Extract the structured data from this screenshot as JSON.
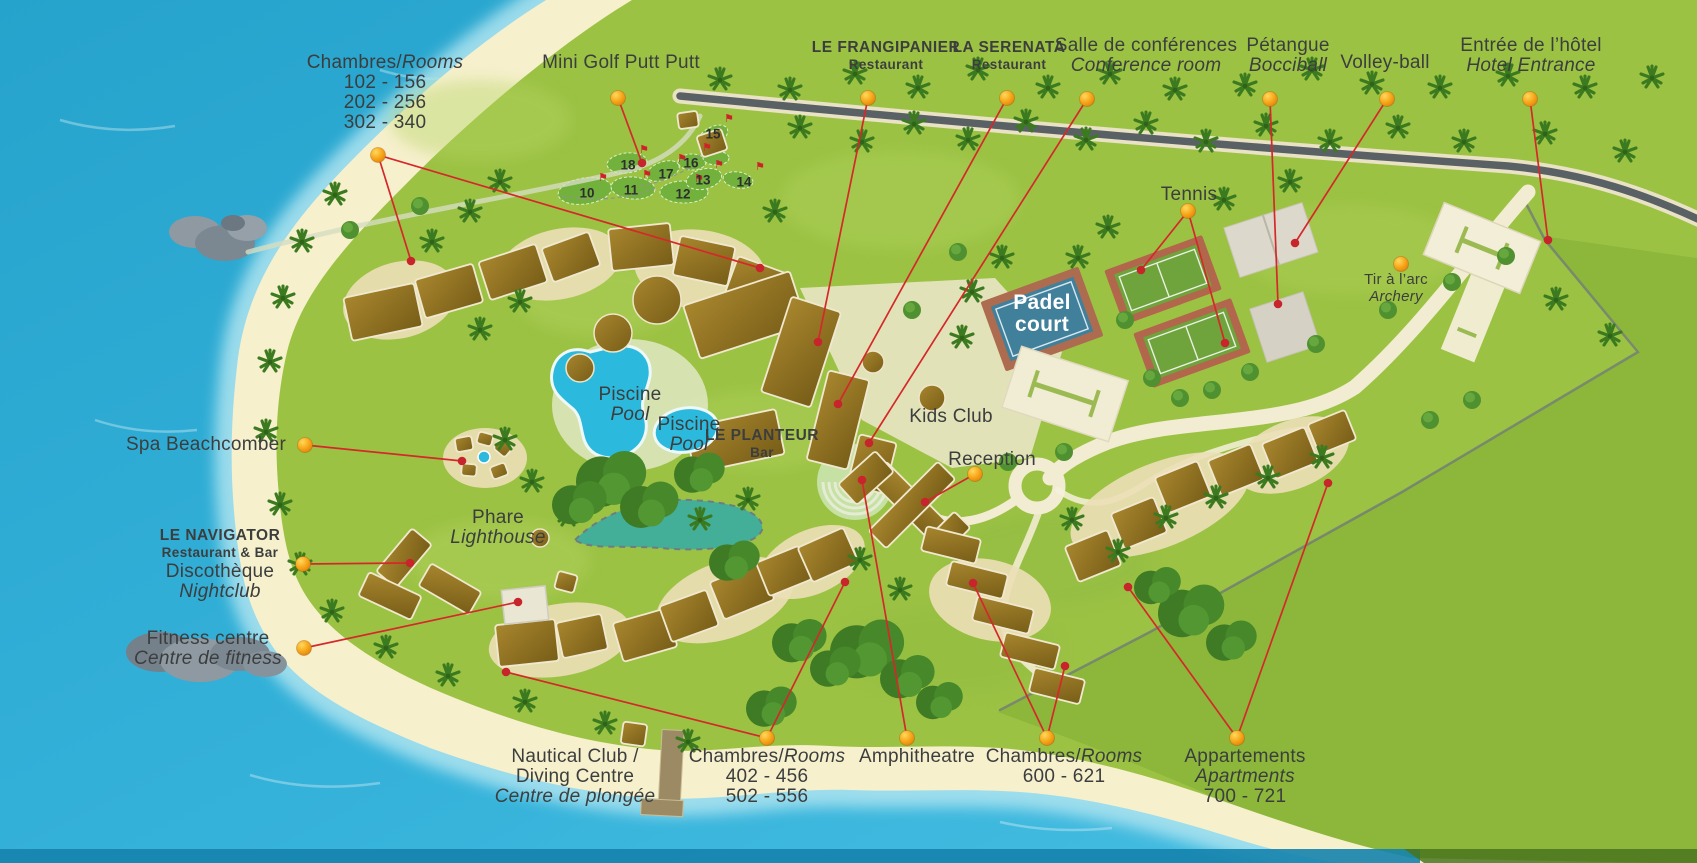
{
  "map_title": "Resort grounds map",
  "colors": {
    "water": "#2aa9d2",
    "water_light": "#49bfe2",
    "sand": "#f6f0cd",
    "grass": "#9cc244",
    "grass_outside": "#7fae33",
    "roof": "#8a6c1e",
    "callout_line": "#d5282a",
    "callout_dot": "#f7a61b",
    "label_text": "#3c3e3e",
    "pool": "#2cb9de",
    "padel_blue": "#41809b",
    "tennis_green": "#6fa33c",
    "court_clay": "#b2664b",
    "road_dark": "#596165",
    "path_cream": "#f2ecd2"
  },
  "callouts": [
    {
      "id": "rooms-nw",
      "x": 385,
      "y": 53,
      "lines": [
        [
          [
            "Chambres/",
            "r"
          ],
          [
            "Rooms",
            "i"
          ]
        ],
        [
          [
            "102 - 156",
            "r"
          ]
        ],
        [
          [
            "202 - 256",
            "r"
          ]
        ],
        [
          [
            "302 - 340",
            "r"
          ]
        ]
      ],
      "dot": [
        378,
        155
      ],
      "targets": [
        [
          411,
          261
        ],
        [
          760,
          268
        ]
      ]
    },
    {
      "id": "mini-golf",
      "x": 621,
      "y": 53,
      "lines": [
        [
          [
            "Mini Golf Putt Putt",
            "r"
          ]
        ]
      ],
      "dot": [
        618,
        98
      ],
      "targets": [
        [
          642,
          163
        ]
      ]
    },
    {
      "id": "frangipanier",
      "x": 886,
      "y": 40,
      "lines": [
        [
          [
            "LE FRANGIPANIER",
            "b"
          ]
        ],
        [
          [
            "Restaurant",
            "b2"
          ]
        ]
      ],
      "dot": [
        868,
        98
      ],
      "targets": [
        [
          818,
          342
        ]
      ]
    },
    {
      "id": "serenata",
      "x": 1009,
      "y": 40,
      "lines": [
        [
          [
            "LA SERENATA",
            "b"
          ]
        ],
        [
          [
            "Restaurant",
            "b2"
          ]
        ]
      ],
      "dot": [
        1007,
        98
      ],
      "targets": [
        [
          838,
          404
        ]
      ]
    },
    {
      "id": "conference",
      "x": 1146,
      "y": 36,
      "lines": [
        [
          [
            "Salle de conférences",
            "r"
          ]
        ],
        [
          [
            "Conference room",
            "i"
          ]
        ]
      ],
      "dot": [
        1087,
        99
      ],
      "targets": [
        [
          869,
          443
        ]
      ]
    },
    {
      "id": "petangue",
      "x": 1288,
      "y": 36,
      "lines": [
        [
          [
            "Pétangue",
            "r"
          ]
        ],
        [
          [
            "Bocciball",
            "i"
          ]
        ]
      ],
      "dot": [
        1270,
        99
      ],
      "targets": [
        [
          1278,
          304
        ]
      ]
    },
    {
      "id": "volleyball",
      "x": 1385,
      "y": 53,
      "lines": [
        [
          [
            "Volley-ball",
            "r"
          ]
        ]
      ],
      "dot": [
        1387,
        99
      ],
      "targets": [
        [
          1295,
          243
        ]
      ]
    },
    {
      "id": "hotel-entrance",
      "x": 1531,
      "y": 36,
      "lines": [
        [
          [
            "Entrée de l’hôtel",
            "r"
          ]
        ],
        [
          [
            "Hotel Entrance",
            "i"
          ]
        ]
      ],
      "dot": [
        1530,
        99
      ],
      "targets": [
        [
          1548,
          240
        ]
      ]
    },
    {
      "id": "tennis",
      "x": 1189,
      "y": 185,
      "lines": [
        [
          [
            "Tennis",
            "r"
          ]
        ]
      ],
      "dot": [
        1188,
        211
      ],
      "targets": [
        [
          1141,
          270
        ],
        [
          1225,
          343
        ]
      ]
    },
    {
      "id": "padel-court",
      "x": 1042,
      "y": 292,
      "lines": [
        [
          [
            "Padel",
            "w"
          ]
        ],
        [
          [
            "court",
            "w"
          ]
        ]
      ]
    },
    {
      "id": "archery",
      "x": 1396,
      "y": 272,
      "lines": [
        [
          [
            "Tir à l’arc",
            "sm"
          ]
        ],
        [
          [
            "Archery",
            "smi"
          ]
        ]
      ],
      "dot": [
        1401,
        264
      ]
    },
    {
      "id": "kids-club",
      "x": 951,
      "y": 407,
      "lines": [
        [
          [
            "Kids Club",
            "r"
          ]
        ]
      ]
    },
    {
      "id": "reception",
      "x": 992,
      "y": 450,
      "lines": [
        [
          [
            "Reception",
            "r"
          ]
        ]
      ],
      "dot": [
        975,
        474
      ],
      "targets": [
        [
          925,
          502
        ]
      ]
    },
    {
      "id": "pool-1",
      "x": 630,
      "y": 385,
      "lines": [
        [
          [
            "Piscine",
            "r"
          ]
        ],
        [
          [
            "Pool",
            "i"
          ]
        ]
      ]
    },
    {
      "id": "pool-2",
      "x": 689,
      "y": 415,
      "lines": [
        [
          [
            "Piscine",
            "r"
          ]
        ],
        [
          [
            "Pool",
            "i"
          ]
        ]
      ]
    },
    {
      "id": "planteur",
      "x": 762,
      "y": 428,
      "lines": [
        [
          [
            "LE PLANTEUR",
            "b"
          ]
        ],
        [
          [
            "Bar",
            "b2"
          ]
        ]
      ]
    },
    {
      "id": "spa",
      "x": 206,
      "y": 435,
      "lines": [
        [
          [
            "Spa Beachcomber",
            "r"
          ]
        ]
      ],
      "dot": [
        305,
        445
      ],
      "targets": [
        [
          462,
          461
        ]
      ]
    },
    {
      "id": "lighthouse",
      "x": 498,
      "y": 508,
      "lines": [
        [
          [
            "Phare",
            "r"
          ]
        ],
        [
          [
            "Lighthouse",
            "i"
          ]
        ]
      ]
    },
    {
      "id": "navigator",
      "x": 220,
      "y": 528,
      "lines": [
        [
          [
            "LE NAVIGATOR",
            "b"
          ]
        ],
        [
          [
            "Restaurant & Bar",
            "b2"
          ]
        ],
        [
          [
            "Discothèque",
            "r"
          ]
        ],
        [
          [
            "Nightclub",
            "i"
          ]
        ]
      ],
      "dot": [
        303,
        564
      ],
      "targets": [
        [
          410,
          563
        ]
      ]
    },
    {
      "id": "fitness",
      "x": 208,
      "y": 629,
      "lines": [
        [
          [
            "Fitness centre",
            "r"
          ]
        ],
        [
          [
            "Centre de fitness",
            "i"
          ]
        ]
      ],
      "dot": [
        304,
        648
      ],
      "targets": [
        [
          518,
          602
        ]
      ]
    },
    {
      "id": "nautical",
      "x": 575,
      "y": 747,
      "lines": [
        [
          [
            "Nautical Club /",
            "r"
          ]
        ],
        [
          [
            "Diving Centre",
            "r"
          ]
        ],
        [
          [
            "Centre de plongée",
            "i"
          ]
        ]
      ]
    },
    {
      "id": "rooms-400",
      "x": 767,
      "y": 747,
      "lines": [
        [
          [
            "Chambres/",
            "r"
          ],
          [
            "Rooms",
            "i"
          ]
        ],
        [
          [
            "402 - 456",
            "r"
          ]
        ],
        [
          [
            "502 - 556",
            "r"
          ]
        ]
      ],
      "dot": [
        767,
        738
      ],
      "targets": [
        [
          506,
          672
        ],
        [
          845,
          582
        ]
      ]
    },
    {
      "id": "amphitheatre",
      "x": 917,
      "y": 747,
      "lines": [
        [
          [
            "Amphitheatre",
            "r"
          ]
        ]
      ],
      "dot": [
        907,
        738
      ],
      "targets": [
        [
          862,
          480
        ]
      ]
    },
    {
      "id": "rooms-600",
      "x": 1064,
      "y": 747,
      "lines": [
        [
          [
            "Chambres/",
            "r"
          ],
          [
            "Rooms",
            "i"
          ]
        ],
        [
          [
            "600 - 621",
            "r"
          ]
        ]
      ],
      "dot": [
        1047,
        738
      ],
      "targets": [
        [
          973,
          583
        ],
        [
          1065,
          666
        ]
      ]
    },
    {
      "id": "apartments",
      "x": 1245,
      "y": 747,
      "lines": [
        [
          [
            "Appartements",
            "r"
          ]
        ],
        [
          [
            "Apartments",
            "i"
          ]
        ],
        [
          [
            "700 - 721",
            "r"
          ]
        ]
      ],
      "dot": [
        1237,
        738
      ],
      "targets": [
        [
          1128,
          587
        ],
        [
          1328,
          483
        ]
      ]
    }
  ],
  "minigolf_holes": [
    {
      "n": "10",
      "x": 587,
      "y": 193
    },
    {
      "n": "11",
      "x": 631,
      "y": 190
    },
    {
      "n": "12",
      "x": 683,
      "y": 194
    },
    {
      "n": "13",
      "x": 703,
      "y": 180
    },
    {
      "n": "14",
      "x": 744,
      "y": 182
    },
    {
      "n": "15",
      "x": 713,
      "y": 134
    },
    {
      "n": "16",
      "x": 691,
      "y": 163
    },
    {
      "n": "17",
      "x": 666,
      "y": 174
    },
    {
      "n": "18",
      "x": 628,
      "y": 165
    }
  ]
}
